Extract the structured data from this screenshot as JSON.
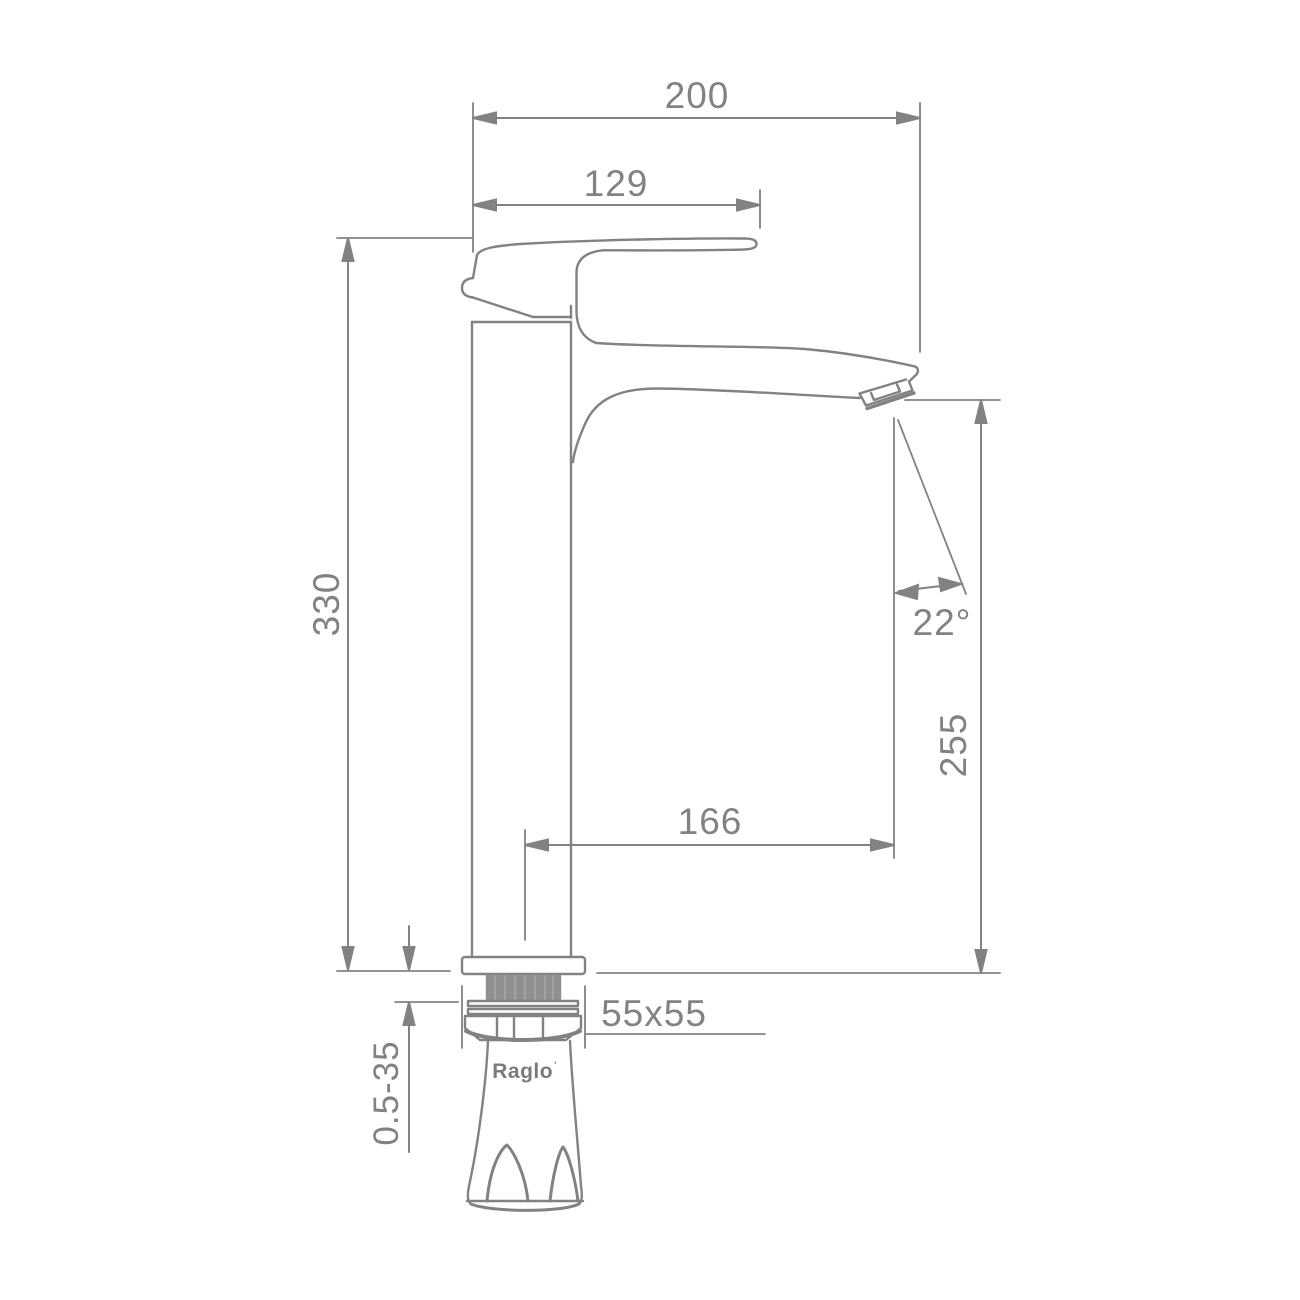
{
  "drawing": {
    "type": "faucet-technical-dimension-drawing",
    "brand": {
      "name": "Raglo",
      "mark": "'"
    },
    "dimensions": {
      "overall_depth": "200",
      "handle_length": "129",
      "overall_height": "330",
      "spout_outlet_height": "255",
      "spout_reach": "166",
      "spout_angle": "22°",
      "base_footprint": "55x55",
      "deck_thickness_range": "0.5-35"
    },
    "colors": {
      "line": "#828282",
      "thread_fill": "#8f8f8f",
      "background": "#ffffff"
    }
  }
}
